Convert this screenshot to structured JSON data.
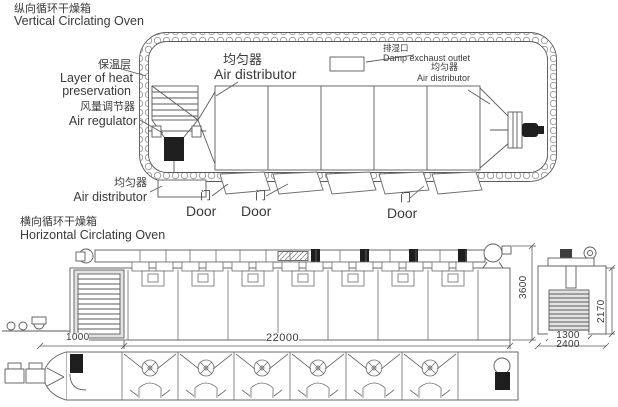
{
  "top_oven": {
    "title_zh": "纵向循环干燥箱",
    "title_en": "Vertical Circlating Oven",
    "labels": {
      "insulation_zh": "保温层",
      "insulation_en1": "Layer of heat",
      "insulation_en2": "preservation",
      "air_regulator_zh": "风量调节器",
      "air_regulator_en": "Air regulator",
      "air_distributor_left_zh": "均匀器",
      "air_distributor_left_en": "Air distributor",
      "air_distributor_mid_zh": "均匀器",
      "air_distributor_mid_en": "Air distributor",
      "damp_outlet_zh": "排湿口",
      "damp_outlet_en": "Damp exchaust outlet",
      "air_distributor_right_zh": "均匀器",
      "air_distributor_right_en": "Air distributor",
      "door_zh": "门",
      "door_en": "Door"
    }
  },
  "bottom_oven": {
    "title_zh": "横向循环干燥箱",
    "title_en": "Horizontal Circlating Oven",
    "dimensions": {
      "front_left": "1000",
      "total_length": "22000",
      "height": "3600",
      "side_height": "2170",
      "side_inner_width": "1300",
      "side_width": "2400"
    }
  },
  "colors": {
    "line": "#5a5a5a",
    "text": "#3a3a3a",
    "dark_fill": "#1e1e1e",
    "hatch_fill": "#e3e3e3"
  }
}
